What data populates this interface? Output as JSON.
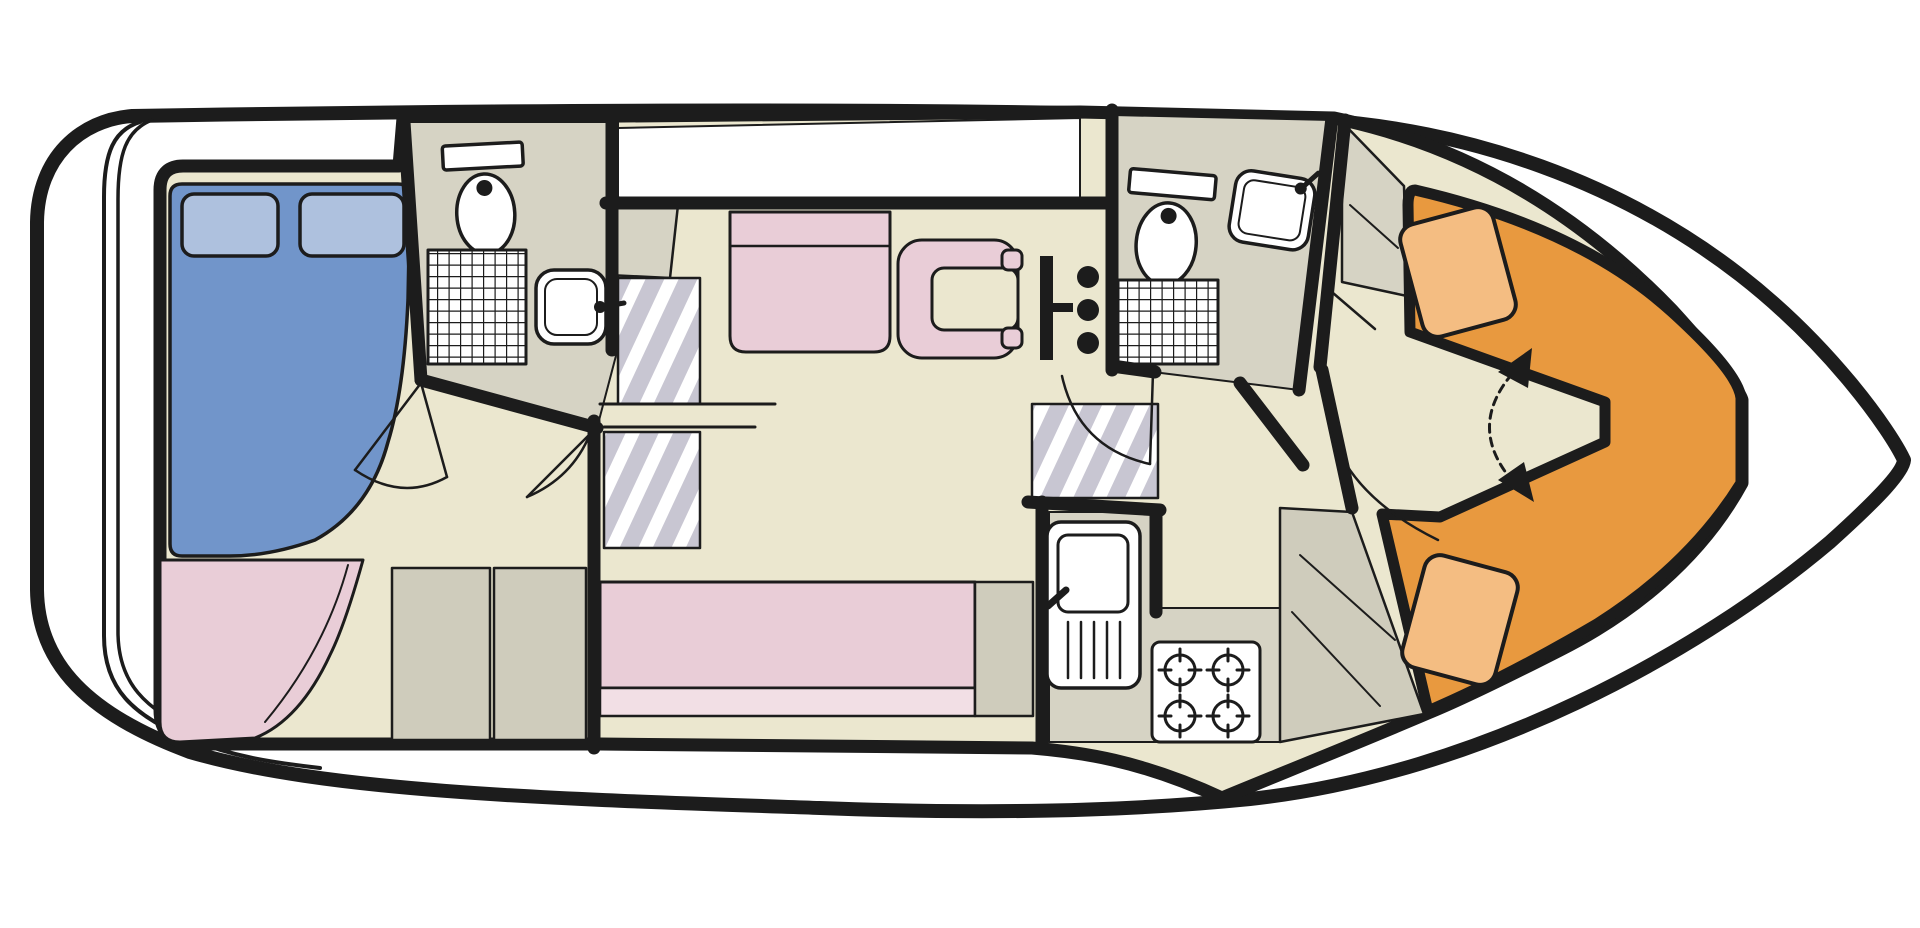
{
  "diagram": {
    "kind": "boat-deck-plan",
    "orientation": {
      "bow": "right",
      "stern": "left",
      "view": "top-down"
    },
    "rooms": [
      {
        "id": "aft_cabin",
        "name": "aft-cabin",
        "furniture": [
          "double-bed",
          "pillow-left",
          "pillow-right",
          "corner-sofa",
          "storage-cabinets"
        ]
      },
      {
        "id": "aft_bathroom",
        "name": "aft-bathroom",
        "fixtures": [
          "toilet",
          "shower",
          "washbasin"
        ]
      },
      {
        "id": "companionway",
        "name": "companionway-stairs",
        "furniture": [
          "entry-step",
          "stair-flight-upper",
          "stair-flight-lower"
        ]
      },
      {
        "id": "saloon",
        "name": "saloon-wheelhouse",
        "furniture": [
          "bench-seat",
          "helm-seat",
          "helm-console",
          "long-sofa",
          "sofa-end-cabinet"
        ]
      },
      {
        "id": "forward_bathroom",
        "name": "forward-bathroom",
        "fixtures": [
          "toilet",
          "washbasin",
          "shower"
        ]
      },
      {
        "id": "galley",
        "name": "galley",
        "fixtures": [
          "sink-with-drainer",
          "four-burner-stove"
        ]
      },
      {
        "id": "bow_cabin",
        "name": "bow-cabin",
        "furniture": [
          "v-berth",
          "berth-cushion-top",
          "berth-cushion-bottom",
          "conversion-arrow",
          "wardrobe"
        ]
      }
    ],
    "colors": {
      "outline": "#1c1c1c",
      "white": "#ffffff",
      "floor": "#ebe7cf",
      "room_grey": "#d6d3c4",
      "cabinet_grey": "#cfccbc",
      "step_base": "#c8c6d2",
      "step_stripe": "#ffffff",
      "pink": "#e9cdd7",
      "pink_light": "#f2dfe5",
      "blue": "#7195ca",
      "blue_light": "#aec1de",
      "orange": "#e8993f",
      "orange_light": "#f4bd82",
      "fixture_white": "#ffffff"
    }
  }
}
